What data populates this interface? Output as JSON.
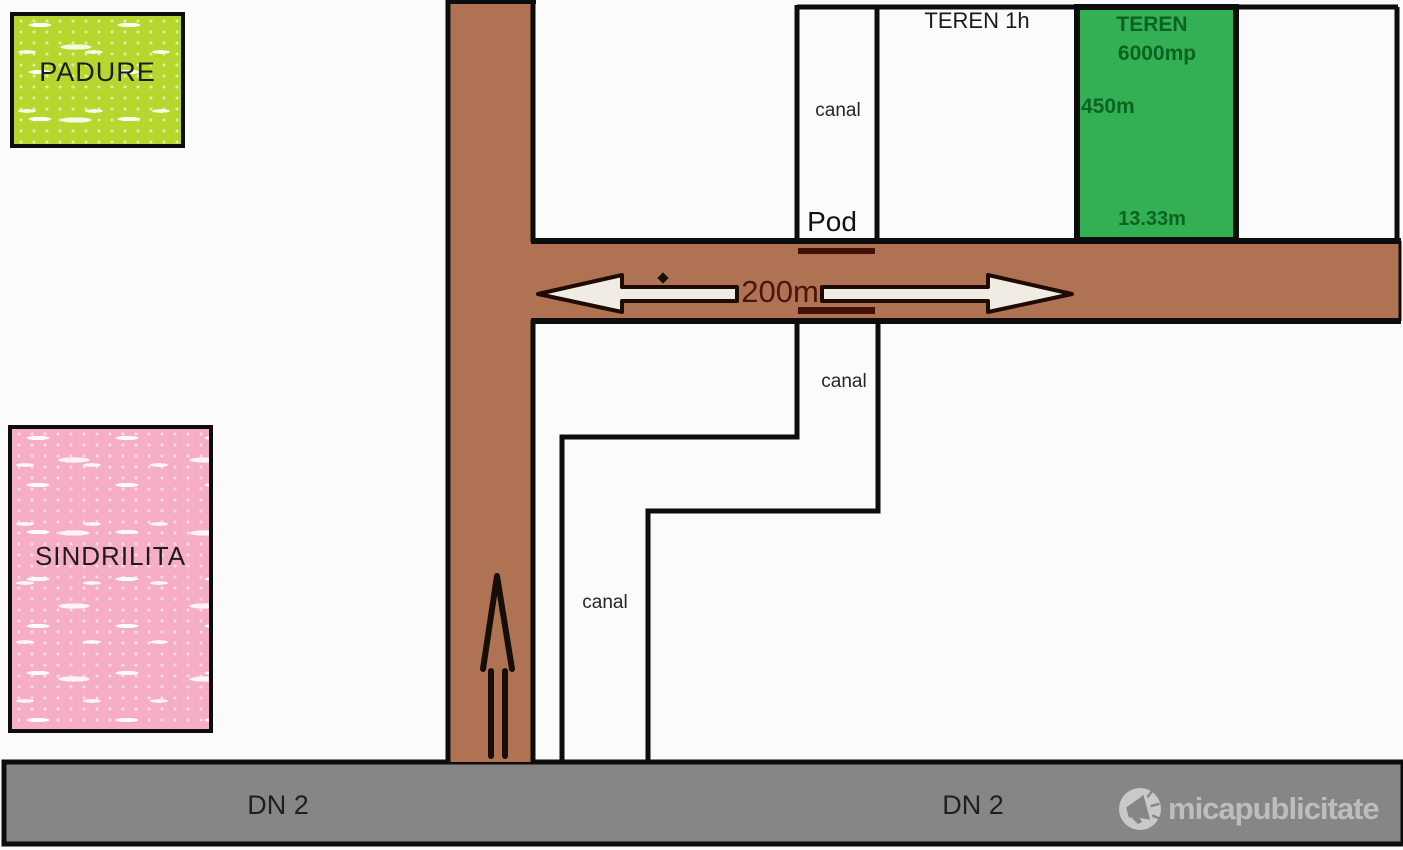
{
  "colors": {
    "background": "#fbfbfb",
    "road_brown": "#af7354",
    "highway_gray": "#868686",
    "forest_green": "#b5d72e",
    "locality_pink": "#f6aec6",
    "parcel_green": "#33b053",
    "parcel_text": "#0b6322",
    "bridge_maroon": "#431008",
    "distance_text": "#4a150a",
    "line_black": "#0d0d0d",
    "watermark_gray": "#bdbdbd"
  },
  "map": {
    "forest": {
      "label": "PADURE"
    },
    "locality": {
      "label": "SINDRILITA"
    },
    "parcel_1h": {
      "label": "TEREN 1h"
    },
    "parcel_green": {
      "title": "TEREN",
      "area": "6000mp",
      "length": "450m",
      "width": "13.33m"
    },
    "canal_labels": {
      "top": "canal",
      "middle": "canal",
      "lower": "canal"
    },
    "bridge": {
      "label": "Pod"
    },
    "road": {
      "distance": "200m"
    },
    "highway": {
      "label_left": "DN 2",
      "label_right": "DN 2"
    }
  },
  "watermark": {
    "brand": "micapublicitate"
  }
}
